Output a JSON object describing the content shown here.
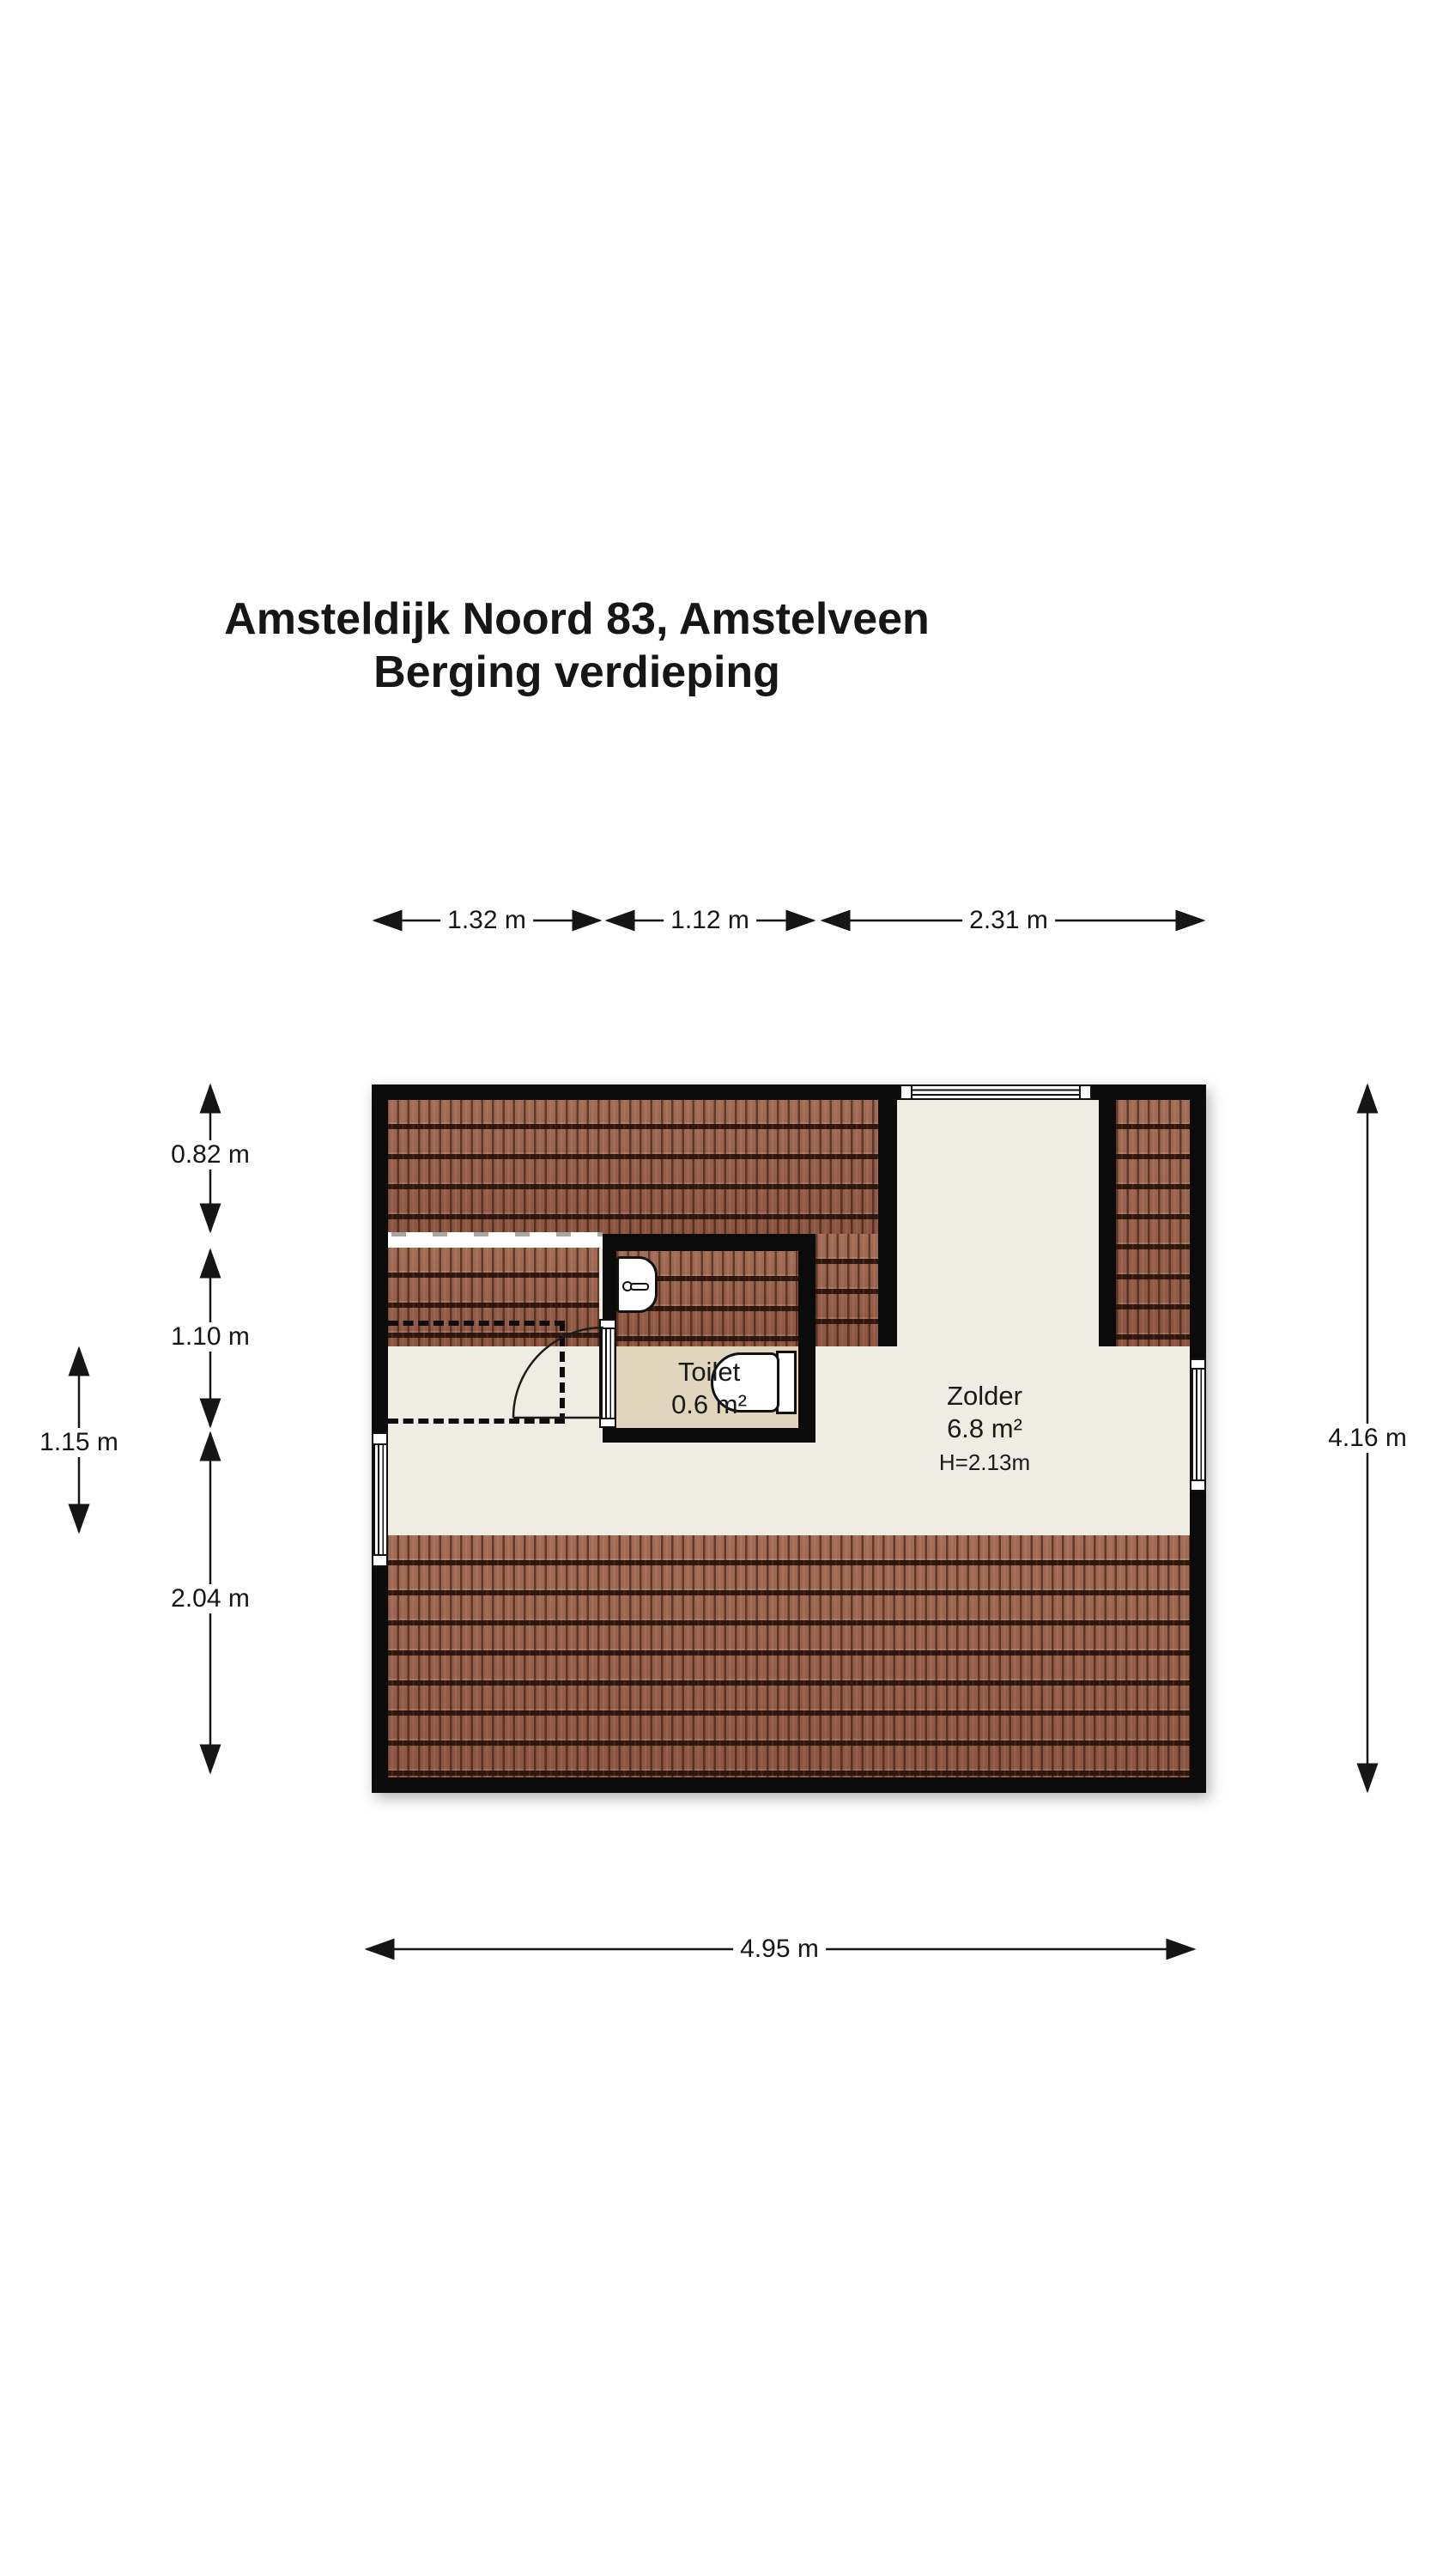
{
  "title": {
    "line1": "Amsteldijk Noord 83, Amstelveen",
    "line2": "Berging verdieping"
  },
  "rooms": {
    "toilet": {
      "name": "Toilet",
      "area": "0.6 m²"
    },
    "zolder": {
      "name": "Zolder",
      "area": "6.8 m²",
      "ceiling_height": "H=2.13m"
    }
  },
  "dimensions": {
    "top": [
      "1.32 m",
      "1.12 m",
      "2.31 m"
    ],
    "left_inner": [
      "0.82 m",
      "1.10 m",
      "2.04 m"
    ],
    "left_outer": "1.15 m",
    "right": "4.16 m",
    "bottom": "4.95 m"
  },
  "colors": {
    "roof_tile": "#99614a",
    "roof_tile_dark_line": "#2f170e",
    "wall": "#0b0b0b",
    "attic_floor": "#efece3",
    "toilet_floor": "#e1d5bd",
    "background": "#ffffff"
  }
}
